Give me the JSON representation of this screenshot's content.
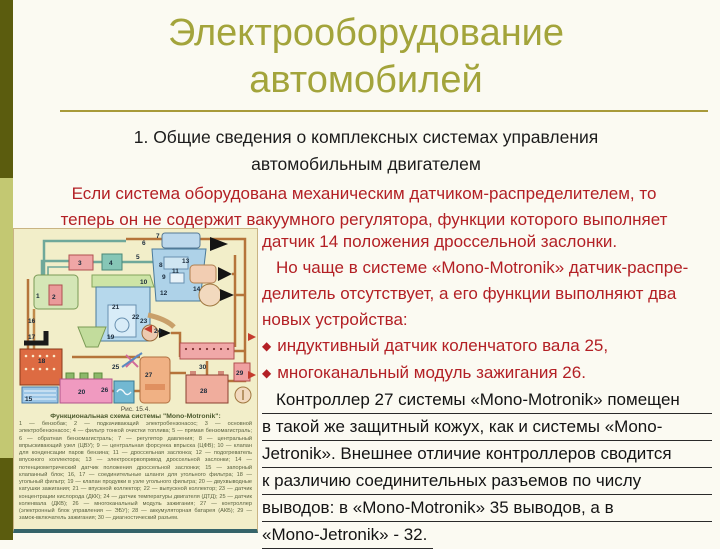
{
  "slide": {
    "title_lines": [
      "Электрооборудование",
      "автомобилей"
    ],
    "subtitle_lines": [
      "1. Общие сведения о комплексных системах управления",
      "автомобильным двигателем"
    ],
    "intro_lines": [
      "Если система оборудована механическим датчиком-распределителем, то",
      "теперь он не содержит вакуумного регулятора, функции которого выполняет"
    ],
    "red_lines": [
      "датчик 14 положения дроссельной заслонки.",
      "Но чаще в системе «Mono-Motronik» датчик-распре-",
      "делитель отсутствует, а его функции выполняют два",
      "новых устройства:"
    ],
    "bullet_glyph": "◆",
    "bullets": [
      "индуктивный датчик коленчатого вала 25,",
      "многоканальный модуль зажигания 26."
    ],
    "underlined_lines": [
      "Контроллер 27 системы «Mono-Motronik» помещен",
      "в такой же защитный кожух, как и системы «Mono-",
      "Jetronik». Внешнее отличие контроллеров сводится",
      "к различию соединительных разъемов по числу",
      "выводов: в «Mono-Motronik» 35 выводов, а в",
      "«Mono-Jetronik» - 32."
    ]
  },
  "figure": {
    "fig_number": "Рис. 15.4.",
    "fig_title": "Функциональная схема системы \"Mono-Motronik\":",
    "legend": "1 — бензобак; 2 — подкачивающий электробензонасос; 3 — основной электробензонасос; 4 — фильтр тонкой очистки топлива; 5 — прямая бензомагистраль; 6 — обратная бензомагистраль; 7 — регулятор давления; 8 — центральный впрыскивающий узел (ЦВУ); 9 — центральная форсунка впрыска (ЦФВ); 10 — клапан для конденсации паров бензина; 11 — дроссельная заслонка; 12 — подогреватель впускного коллектора; 13 — электросервопривод дроссельной заслонки; 14 — потенциометрический датчик положения дроссельной заслонки; 15 — запорный клапанный блок; 16, 17 — соединительные шланги для угольного фильтра; 18 — угольный фильтр; 19 — клапан продувки в узле угольного фильтра; 20 — двухвыводные катушки зажигания; 21 — впускной коллектор; 22 — выпускной коллектор; 23 — датчик концентрации кислорода (ДКК); 24 — датчик температуры двигателя (ДТД); 25 — датчик коленвала (ДКВ); 26 — многоканальный модуль зажигания; 27 — контроллер (электронный блок управления — ЭБУ); 28 — аккумуляторная батарея (АКБ); 29 — замок-включатель зажигания; 30 — диагностический разъем.",
    "diagram_labels": [
      "1",
      "2",
      "3",
      "4",
      "5",
      "6",
      "7",
      "8",
      "9",
      "10",
      "11",
      "12",
      "13",
      "14",
      "15",
      "16",
      "17",
      "18",
      "19",
      "20",
      "21",
      "22",
      "23",
      "24",
      "25",
      "26",
      "27",
      "28",
      "29",
      "30"
    ]
  },
  "colors": {
    "bar_dark": "#5b5c0e",
    "bar_light": "#c3c872",
    "title": "#a3a43b",
    "rule": "#a89a3a",
    "red_text": "#b32025",
    "black_text": "#1c1c1c",
    "background": "#fbfaf2",
    "figure_bg": "#f2eec9",
    "figure_bottom_line": "#35646a"
  }
}
